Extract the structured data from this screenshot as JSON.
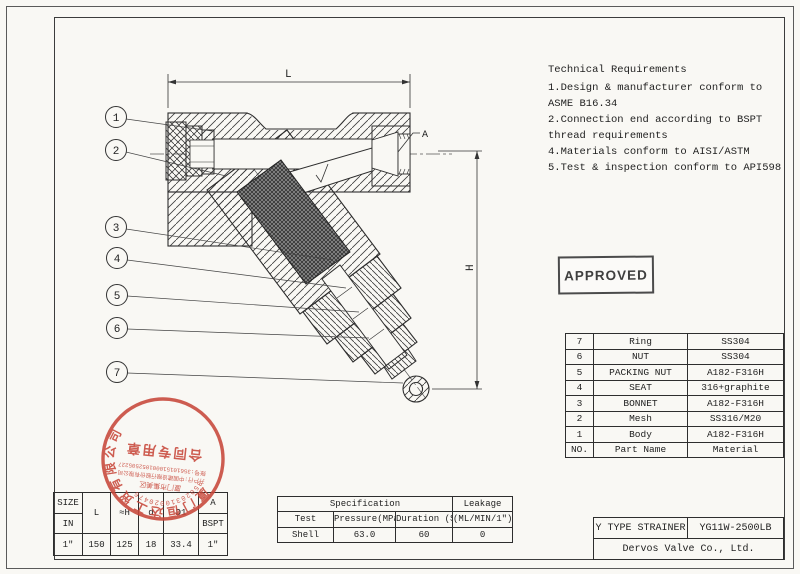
{
  "tech": {
    "title": "Technical Requirements",
    "items": [
      "1.Design & manufacturer conform to ASME B16.34",
      "2.Connection end according to BSPT thread requirements",
      "4.Materials conform to AISI/ASTM",
      "5.Test & inspection conform to API598"
    ]
  },
  "approved": {
    "label": "APPROVED"
  },
  "parts": {
    "rows": [
      [
        "7",
        "Ring",
        "SS304"
      ],
      [
        "6",
        "NUT",
        "SS304"
      ],
      [
        "5",
        "PACKING NUT",
        "A182-F316H"
      ],
      [
        "4",
        "SEAT",
        "316+graphite"
      ],
      [
        "3",
        "BONNET",
        "A182-F316H"
      ],
      [
        "2",
        "Mesh",
        "SS316/M20"
      ],
      [
        "1",
        "Body",
        "A182-F316H"
      ],
      [
        "NO.",
        "Part Name",
        "Material"
      ]
    ]
  },
  "title_block": {
    "product": "Y TYPE STRAINER",
    "model": "YG11W-2500LB",
    "company": "Dervos Valve Co., Ltd."
  },
  "spec": {
    "title": "Specification",
    "leakage": "Leakage",
    "headers": [
      "Test",
      "Pressure(MPa)",
      "Duration (S)",
      "(ML/MIN/1\")"
    ],
    "values": [
      "Shell",
      "63.0",
      "60",
      "0"
    ]
  },
  "size": {
    "col1": [
      "SIZE",
      "IN"
    ],
    "spans": [
      "L",
      "≈H",
      "d",
      "D1"
    ],
    "col6": [
      "A",
      "BSPT"
    ],
    "values": [
      "1\"",
      "150",
      "125",
      "18",
      "33.4",
      "1\""
    ]
  },
  "drawing": {
    "dims": {
      "l": "L",
      "h": "H",
      "a": "A"
    },
    "balloons": [
      "1",
      "2",
      "3",
      "4",
      "5",
      "6",
      "7"
    ]
  },
  "stamp": {
    "color": "#c8473a",
    "outer_digits": "35020310020476",
    "district": "厦门市集美区",
    "bank": "开户行:中国建设银行股份有限公司",
    "account": "账号:356101510001052505227",
    "center": "合同专用章",
    "ring": "厦门恒达工贸有限公司"
  }
}
